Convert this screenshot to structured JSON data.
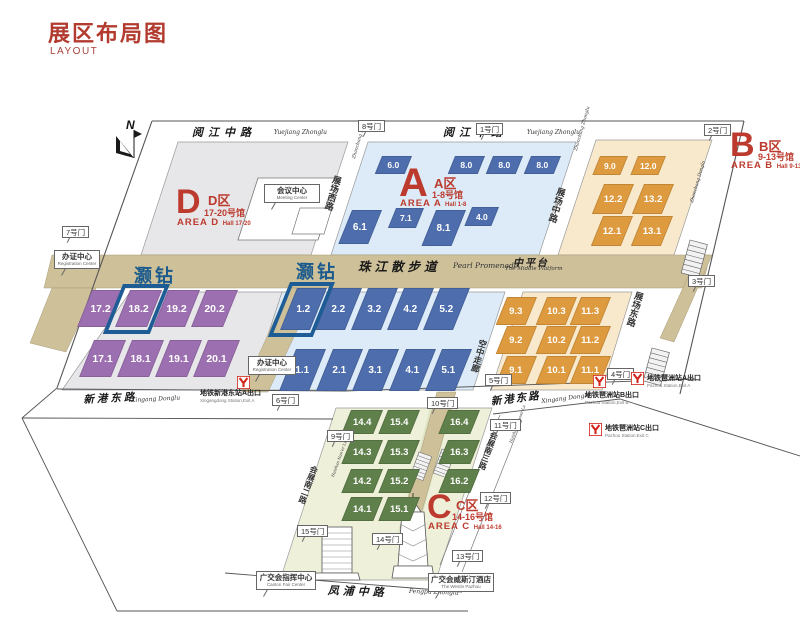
{
  "title": {
    "zh": "展区布局图",
    "en": "LAYOUT"
  },
  "north": {
    "label": "N"
  },
  "colors": {
    "title_red": "#b23a2e",
    "area_red": "#bc3b2e",
    "hall_purple": "#9c6fb0",
    "hall_blue": "#4d6dac",
    "hall_orange": "#dd9a3e",
    "hall_green": "#5f7f4b",
    "floor_d": "#e7e6e9",
    "floor_a": "#dcebf7",
    "floor_b": "#f8e9cd",
    "floor_c": "#eef0da",
    "promenade_beige": "#cec099",
    "metro_red": "#d2261c",
    "highlight_blue": "#1d5c94",
    "haozuan_blue": "#1b5a8d"
  },
  "areas": [
    {
      "letter": "D",
      "name_zh": "D区",
      "halls_zh": "17-20号馆",
      "name_en": "AREA D",
      "halls_en": "Hall 17-20"
    },
    {
      "letter": "A",
      "name_zh": "A区",
      "halls_zh": "1-8号馆",
      "name_en": "AREA A",
      "halls_en": "Hall 1-8"
    },
    {
      "letter": "B",
      "name_zh": "B区",
      "halls_zh": "9-13号馆",
      "name_en": "AREA B",
      "halls_en": "Hall 9-13"
    },
    {
      "letter": "C",
      "name_zh": "C区",
      "halls_zh": "14-16号馆",
      "name_en": "AREA C",
      "halls_en": "Hall 14-16"
    }
  ],
  "special_labels": [
    {
      "text": "灏钻",
      "x": 134,
      "y": 262
    },
    {
      "text": "灏钻",
      "x": 296,
      "y": 258
    }
  ],
  "highlighted_halls": [
    "18.2",
    "1.2"
  ],
  "halls": [
    {
      "n": "17.2",
      "a": "D",
      "x": 92,
      "y": 290,
      "w": 32,
      "h": 37
    },
    {
      "n": "18.2",
      "a": "D",
      "x": 130,
      "y": 290,
      "w": 32,
      "h": 37,
      "hl": true
    },
    {
      "n": "19.2",
      "a": "D",
      "x": 168,
      "y": 290,
      "w": 32,
      "h": 37
    },
    {
      "n": "20.2",
      "a": "D",
      "x": 206,
      "y": 290,
      "w": 32,
      "h": 37
    },
    {
      "n": "17.1",
      "a": "D",
      "x": 94,
      "y": 340,
      "w": 32,
      "h": 37
    },
    {
      "n": "18.1",
      "a": "D",
      "x": 132,
      "y": 340,
      "w": 32,
      "h": 37
    },
    {
      "n": "19.1",
      "a": "D",
      "x": 170,
      "y": 340,
      "w": 32,
      "h": 37
    },
    {
      "n": "20.1",
      "a": "D",
      "x": 208,
      "y": 340,
      "w": 32,
      "h": 37
    },
    {
      "n": "6.0",
      "a": "A",
      "x": 382,
      "y": 156,
      "w": 30,
      "h": 18
    },
    {
      "n": "8.0",
      "a": "A",
      "x": 455,
      "y": 156,
      "w": 30,
      "h": 18
    },
    {
      "n": "8.0",
      "a": "A",
      "x": 493,
      "y": 156,
      "w": 30,
      "h": 18
    },
    {
      "n": "8.0",
      "a": "A",
      "x": 531,
      "y": 156,
      "w": 30,
      "h": 18
    },
    {
      "n": "6.1",
      "a": "A",
      "x": 352,
      "y": 210,
      "w": 30,
      "h": 34
    },
    {
      "n": "7.1",
      "a": "A",
      "x": 396,
      "y": 208,
      "w": 28,
      "h": 20
    },
    {
      "n": "8.1",
      "a": "A",
      "x": 436,
      "y": 210,
      "w": 30,
      "h": 36
    },
    {
      "n": "4.0",
      "a": "A",
      "x": 472,
      "y": 207,
      "w": 27,
      "h": 19
    },
    {
      "n": "1.2",
      "a": "A",
      "x": 297,
      "y": 288,
      "w": 30,
      "h": 42,
      "hl": true
    },
    {
      "n": "2.2",
      "a": "A",
      "x": 332,
      "y": 288,
      "w": 30,
      "h": 42
    },
    {
      "n": "3.2",
      "a": "A",
      "x": 368,
      "y": 288,
      "w": 30,
      "h": 42
    },
    {
      "n": "4.2",
      "a": "A",
      "x": 404,
      "y": 288,
      "w": 30,
      "h": 42
    },
    {
      "n": "5.2",
      "a": "A",
      "x": 440,
      "y": 288,
      "w": 30,
      "h": 42
    },
    {
      "n": "1.1",
      "a": "A",
      "x": 296,
      "y": 349,
      "w": 30,
      "h": 42
    },
    {
      "n": "2.1",
      "a": "A",
      "x": 333,
      "y": 349,
      "w": 30,
      "h": 42
    },
    {
      "n": "3.1",
      "a": "A",
      "x": 369,
      "y": 349,
      "w": 30,
      "h": 42
    },
    {
      "n": "4.1",
      "a": "A",
      "x": 406,
      "y": 349,
      "w": 30,
      "h": 42
    },
    {
      "n": "5.1",
      "a": "A",
      "x": 442,
      "y": 349,
      "w": 30,
      "h": 42
    },
    {
      "n": "9.0",
      "a": "B",
      "x": 600,
      "y": 156,
      "w": 28,
      "h": 19
    },
    {
      "n": "12.0",
      "a": "B",
      "x": 638,
      "y": 156,
      "w": 28,
      "h": 19
    },
    {
      "n": "12.2",
      "a": "B",
      "x": 604,
      "y": 184,
      "w": 30,
      "h": 30
    },
    {
      "n": "13.2",
      "a": "B",
      "x": 644,
      "y": 184,
      "w": 30,
      "h": 30
    },
    {
      "n": "12.1",
      "a": "B",
      "x": 603,
      "y": 216,
      "w": 30,
      "h": 30
    },
    {
      "n": "13.1",
      "a": "B",
      "x": 643,
      "y": 216,
      "w": 30,
      "h": 30
    },
    {
      "n": "9.3",
      "a": "B",
      "x": 507,
      "y": 297,
      "w": 30,
      "h": 28
    },
    {
      "n": "10.3",
      "a": "B",
      "x": 547,
      "y": 297,
      "w": 30,
      "h": 28
    },
    {
      "n": "11.3",
      "a": "B",
      "x": 581,
      "y": 297,
      "w": 30,
      "h": 28
    },
    {
      "n": "9.2",
      "a": "B",
      "x": 507,
      "y": 326,
      "w": 30,
      "h": 28
    },
    {
      "n": "10.2",
      "a": "B",
      "x": 547,
      "y": 326,
      "w": 30,
      "h": 28
    },
    {
      "n": "11.2",
      "a": "B",
      "x": 581,
      "y": 326,
      "w": 30,
      "h": 28
    },
    {
      "n": "9.1",
      "a": "B",
      "x": 507,
      "y": 356,
      "w": 30,
      "h": 28
    },
    {
      "n": "10.1",
      "a": "B",
      "x": 547,
      "y": 356,
      "w": 30,
      "h": 28
    },
    {
      "n": "11.1",
      "a": "B",
      "x": 581,
      "y": 356,
      "w": 30,
      "h": 28
    },
    {
      "n": "14.4",
      "a": "C",
      "x": 351,
      "y": 410,
      "w": 32,
      "h": 24
    },
    {
      "n": "15.4",
      "a": "C",
      "x": 388,
      "y": 410,
      "w": 32,
      "h": 24
    },
    {
      "n": "16.4",
      "a": "C",
      "x": 448,
      "y": 410,
      "w": 32,
      "h": 24
    },
    {
      "n": "14.3",
      "a": "C",
      "x": 351,
      "y": 440,
      "w": 32,
      "h": 24
    },
    {
      "n": "15.3",
      "a": "C",
      "x": 388,
      "y": 440,
      "w": 32,
      "h": 24
    },
    {
      "n": "16.3",
      "a": "C",
      "x": 448,
      "y": 440,
      "w": 32,
      "h": 24
    },
    {
      "n": "14.2",
      "a": "C",
      "x": 351,
      "y": 469,
      "w": 32,
      "h": 24
    },
    {
      "n": "15.2",
      "a": "C",
      "x": 388,
      "y": 469,
      "w": 32,
      "h": 24
    },
    {
      "n": "16.2",
      "a": "C",
      "x": 448,
      "y": 469,
      "w": 32,
      "h": 24
    },
    {
      "n": "14.1",
      "a": "C",
      "x": 351,
      "y": 497,
      "w": 32,
      "h": 24
    },
    {
      "n": "15.1",
      "a": "C",
      "x": 388,
      "y": 497,
      "w": 32,
      "h": 24
    }
  ],
  "gates": [
    {
      "label": "1号门",
      "x": 476,
      "y": 123
    },
    {
      "label": "2号门",
      "x": 704,
      "y": 124
    },
    {
      "label": "3号门",
      "x": 688,
      "y": 275
    },
    {
      "label": "4号门",
      "x": 607,
      "y": 368
    },
    {
      "label": "5号门",
      "x": 485,
      "y": 374
    },
    {
      "label": "6号门",
      "x": 272,
      "y": 394
    },
    {
      "label": "7号门",
      "x": 62,
      "y": 226
    },
    {
      "label": "8号门",
      "x": 358,
      "y": 120
    },
    {
      "label": "9号门",
      "x": 327,
      "y": 430
    },
    {
      "label": "10号门",
      "x": 427,
      "y": 397
    },
    {
      "label": "11号门",
      "x": 490,
      "y": 419
    },
    {
      "label": "12号门",
      "x": 480,
      "y": 492
    },
    {
      "label": "13号门",
      "x": 452,
      "y": 550
    },
    {
      "label": "14号门",
      "x": 372,
      "y": 533
    },
    {
      "label": "15号门",
      "x": 297,
      "y": 525
    }
  ],
  "roads": [
    {
      "id": "yuejiang-west",
      "zh": {
        "t": "阅江中路",
        "x": 192,
        "y": 124,
        "size": 11,
        "ls": 5,
        "rot": 0,
        "mode": "h"
      },
      "en": {
        "t": "Yuejiang Zhonglu",
        "x": 274,
        "y": 129,
        "size": 6,
        "rot": 0,
        "mode": "h"
      }
    },
    {
      "id": "yuejiang-east",
      "zh": {
        "t": "阅江中路",
        "x": 443,
        "y": 124,
        "size": 11,
        "ls": 5,
        "rot": 0,
        "mode": "h"
      },
      "en": {
        "t": "Yuejiang Zhonglu",
        "x": 527,
        "y": 129,
        "size": 6,
        "rot": 0,
        "mode": "h"
      }
    },
    {
      "id": "pearl-promenade",
      "zh": {
        "t": "珠江散步道",
        "x": 358,
        "y": 256,
        "size": 12.5,
        "ls": 4,
        "rot": 0,
        "mode": "h"
      },
      "en": {
        "t": "Pearl Promenade",
        "x": 453,
        "y": 261,
        "size": 7.5,
        "rot": 0,
        "mode": "h"
      }
    },
    {
      "id": "middle-platform",
      "zh": {
        "t": "中平台",
        "x": 513,
        "y": 254,
        "size": 10,
        "ls": 2,
        "rot": 0,
        "mode": "h"
      },
      "en": {
        "t": "The Middle Platform",
        "x": 505,
        "y": 266,
        "size": 5.5,
        "rot": 0,
        "mode": "h"
      }
    },
    {
      "id": "xingang-west",
      "zh": {
        "t": "新港东路",
        "x": 83,
        "y": 392,
        "size": 10.5,
        "ls": 3,
        "rot": -3,
        "mode": "h"
      },
      "en": {
        "t": "Xingang Donglu",
        "x": 131,
        "y": 397,
        "size": 6,
        "rot": -3,
        "mode": "h"
      }
    },
    {
      "id": "xingang-east",
      "zh": {
        "t": "新港东路",
        "x": 490,
        "y": 394,
        "size": 10.5,
        "ls": 2,
        "rot": -7,
        "mode": "h"
      },
      "en": {
        "t": "Xingang Donglu",
        "x": 541,
        "y": 398,
        "size": 6,
        "rot": -7,
        "mode": "h"
      }
    },
    {
      "id": "fengpu",
      "zh": {
        "t": "凤浦中路",
        "x": 328,
        "y": 582,
        "size": 11,
        "ls": 4,
        "rot": 2,
        "mode": "h"
      },
      "en": {
        "t": "Fengpu Zhonglu",
        "x": 409,
        "y": 588,
        "size": 6,
        "rot": 2,
        "mode": "h"
      }
    },
    {
      "id": "zhanchang-xilu",
      "zh": {
        "t": "展场西路",
        "x": 332,
        "y": 174,
        "size": 9,
        "rot": 16,
        "mode": "v"
      },
      "en": {
        "t": "Zhanchang Xilu",
        "x": 352,
        "y": 158,
        "size": 4.5,
        "rot": -74,
        "mode": "h"
      }
    },
    {
      "id": "zhanchang-zhonglu",
      "zh": {
        "t": "展场中路",
        "x": 556,
        "y": 186,
        "size": 9,
        "rot": 16,
        "mode": "v"
      },
      "en": {
        "t": "Zhanchang Zhonglu",
        "x": 574,
        "y": 150,
        "size": 4.5,
        "rot": -74,
        "mode": "h"
      }
    },
    {
      "id": "zhanchang-donglu",
      "zh": {
        "t": "展场东路",
        "x": 634,
        "y": 290,
        "size": 9,
        "rot": 16,
        "mode": "v"
      },
      "en": {
        "t": "Zhanchang Donglu",
        "x": 690,
        "y": 202,
        "size": 4.5,
        "rot": -74,
        "mode": "h"
      }
    },
    {
      "id": "air-corridor",
      "zh": {
        "t": "空中走廊",
        "x": 478,
        "y": 338,
        "size": 8.5,
        "rot": 16,
        "mode": "v"
      },
      "en": null
    },
    {
      "id": "huizhan-nan2",
      "zh": {
        "t": "会展南二路",
        "x": 310,
        "y": 464,
        "size": 8,
        "rot": 20,
        "mode": "v"
      },
      "en": {
        "t": "Huizhan Nan'er Lu",
        "x": 330,
        "y": 476,
        "size": 4,
        "rot": -70,
        "mode": "h"
      }
    },
    {
      "id": "huizhan-nan3",
      "zh": {
        "t": "会展南三路",
        "x": 490,
        "y": 430,
        "size": 8,
        "rot": 20,
        "mode": "v"
      },
      "en": {
        "t": "Huizhan Nansan Lu",
        "x": 508,
        "y": 442,
        "size": 4,
        "rot": -70,
        "mode": "h"
      }
    }
  ],
  "metro_exits": [
    {
      "id": "xingangdong-a",
      "zh": "地铁新港东站A出口",
      "en": "Xingangdong Station,Exit A",
      "icon_x": 237,
      "icon_y": 376,
      "label_x": 200,
      "label_y": 390
    },
    {
      "id": "pazhou-a",
      "zh": "地铁琶洲站A出口",
      "en": "Pazhou Station,Exit A",
      "icon_x": 631,
      "icon_y": 372,
      "label_x": 647,
      "label_y": 375
    },
    {
      "id": "pazhou-b",
      "zh": "地铁琶洲站B出口",
      "en": "Pazhou Station,Exit B",
      "icon_x": 593,
      "icon_y": 375,
      "label_x": 585,
      "label_y": 392
    },
    {
      "id": "pazhou-c",
      "zh": "地铁琶洲站C出口",
      "en": "Pazhou Station,Exit C",
      "icon_x": 589,
      "icon_y": 423,
      "label_x": 605,
      "label_y": 425
    }
  ],
  "callouts": [
    {
      "id": "registration-west",
      "zh": "办证中心",
      "en": "Registration Center",
      "x": 54,
      "y": 250,
      "w": 46
    },
    {
      "id": "registration-mid",
      "zh": "办证中心",
      "en": "Registration Center",
      "x": 248,
      "y": 356,
      "w": 48
    },
    {
      "id": "meeting-center",
      "zh": "会议中心",
      "en": "Meeting Center",
      "x": 264,
      "y": 184,
      "w": 56
    },
    {
      "id": "canton-fair-center",
      "zh": "广交会指挥中心",
      "en": "Canton Fair Center",
      "x": 256,
      "y": 571,
      "w": 60
    },
    {
      "id": "westin-hotel",
      "zh": "广交会威斯汀酒店",
      "en": "The Westin Pazhou",
      "x": 428,
      "y": 573,
      "w": 64
    }
  ]
}
